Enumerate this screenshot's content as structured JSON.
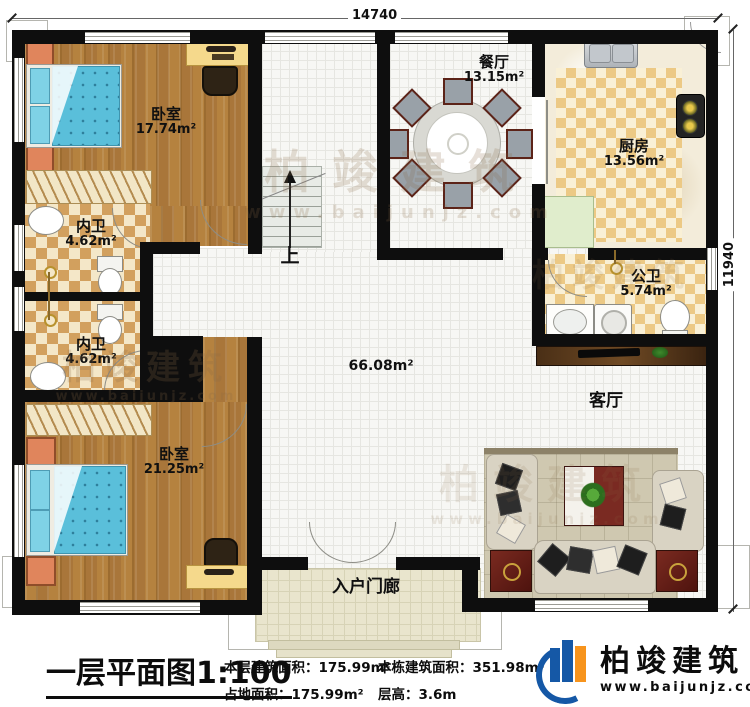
{
  "plan": {
    "dims": {
      "width_mm": "14740",
      "height_mm": "11940"
    },
    "rooms": {
      "bedroom1": {
        "name": "卧室",
        "area": "17.74m²"
      },
      "bath1": {
        "name": "内卫",
        "area": "4.62m²"
      },
      "bath2": {
        "name": "内卫",
        "area": "4.62m²"
      },
      "bedroom2": {
        "name": "卧室",
        "area": "21.25m²"
      },
      "dining": {
        "name": "餐厅",
        "area": "13.15m²"
      },
      "kitchen": {
        "name": "厨房",
        "area": "13.56m²"
      },
      "gongwei": {
        "name": "公卫",
        "area": "5.74m²"
      },
      "living": {
        "name": "客厅"
      },
      "porch": {
        "name": "入户门廊"
      }
    },
    "hall_area": "66.08m²",
    "stairs_label": "上"
  },
  "caption": {
    "title": "一层平面图1:100",
    "col1": [
      "本层建筑面积：175.99m²",
      "占地面积：175.99m²"
    ],
    "col2": [
      "本栋建筑面积：351.98m²",
      "层高：3.6m"
    ]
  },
  "brand": {
    "name": "柏竣建筑",
    "url": "www.baijunjz.com"
  },
  "watermark": {
    "text": "柏竣建筑",
    "url": "www.baijunjz.com"
  },
  "colors": {
    "brand_blue": "#1558a6",
    "brand_orange": "#f7941d",
    "wall": "#0e0e0e",
    "wood": "#ad7a3c"
  }
}
